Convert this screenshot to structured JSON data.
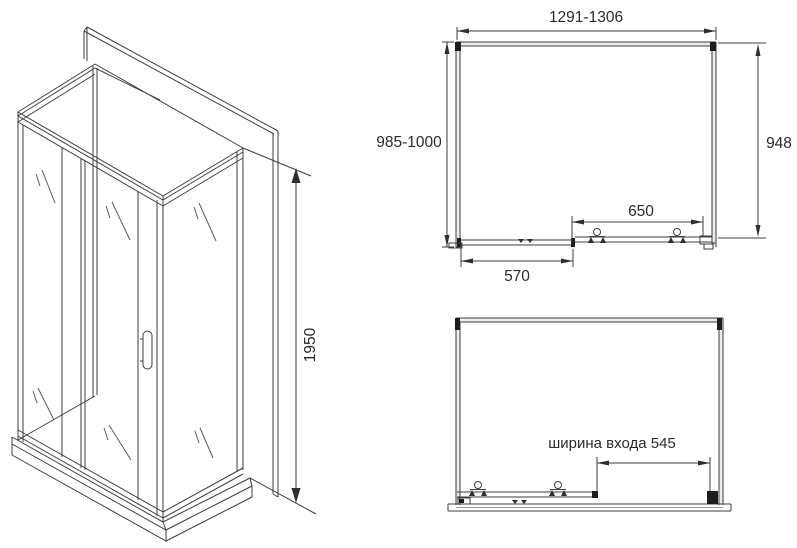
{
  "iso_view": {
    "height_dimension": "1950"
  },
  "plan_top": {
    "width_dimension": "1291-1306",
    "left_depth_dimension": "985-1000",
    "right_depth_dimension": "948",
    "opening_dimension": "650",
    "door_panel_dimension": "570"
  },
  "plan_bottom": {
    "entrance_width_dimension": "ширина входа 545"
  },
  "colors": {
    "line": "#3d3d3d",
    "solid_marker": "#1d1d1d",
    "background": "#ffffff"
  }
}
